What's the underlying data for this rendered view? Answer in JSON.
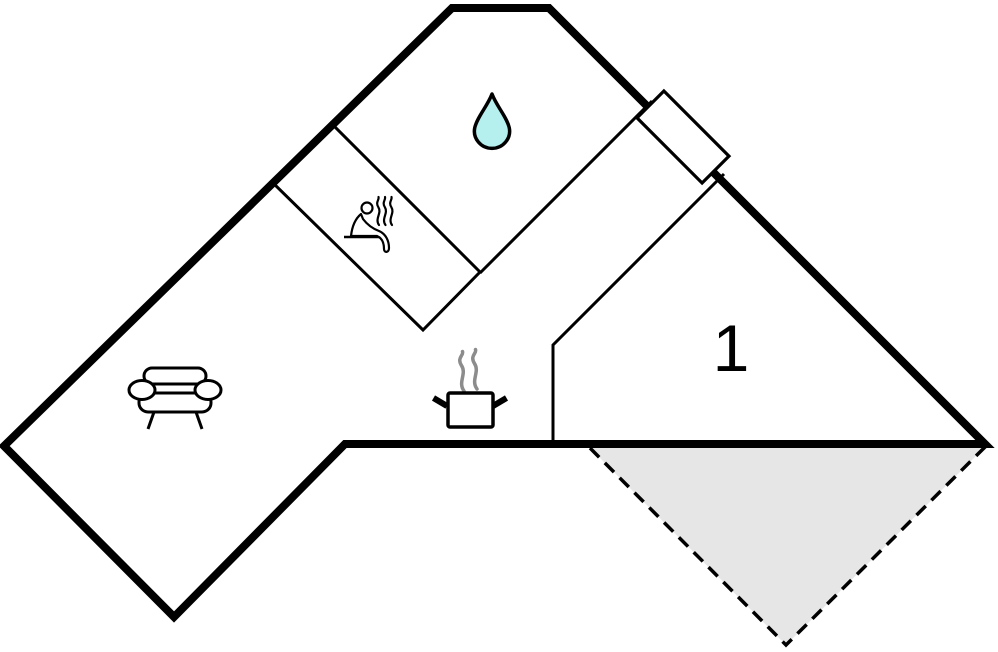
{
  "floor_plan": {
    "type": "holiday-home-floor-plan",
    "rooms": {
      "bedroom_1": {
        "label": "1",
        "icon": "none"
      },
      "bathroom": {
        "icon": "water-drop-icon"
      },
      "sauna": {
        "icon": "sauna-person-icon"
      },
      "living_room": {
        "icon": "sofa-icon"
      },
      "kitchen": {
        "icon": "cooking-pot-icon"
      },
      "terrace": {
        "icon": "terrace-triangle"
      }
    },
    "markers": {
      "entrance": "door-marker"
    }
  },
  "colors": {
    "background": "#ffffff",
    "ink": "#000000",
    "water_drop_fill": "#b5f0ef",
    "terrace_fill": "#e6e6e6",
    "pot_steam": "#8c8c8c"
  }
}
